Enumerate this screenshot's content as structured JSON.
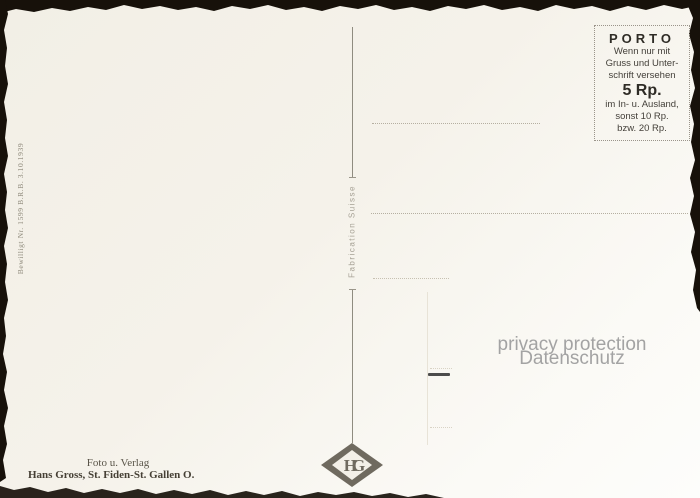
{
  "postcard": {
    "porto_box": {
      "title": "PORTO",
      "lines_top": [
        "Wenn nur mit",
        "Gruss und Unter-",
        "schrift versehen"
      ],
      "rate": "5 Rp.",
      "lines_bottom": [
        "im In- u. Ausland,",
        "sonst 10 Rp.",
        "bzw. 20 Rp."
      ]
    },
    "center_divider_label": "Fabrication Suisse",
    "left_authorization": "Bewilligt Nr. 1599 B.R.B. 3.10.1939",
    "publisher": {
      "line1": "Foto u. Verlag",
      "line2": "Hans Gross, St. Fiden-St. Gallen O."
    },
    "logo_monogram": "HG",
    "watermark": {
      "line1": "privacy protection",
      "line2": "Datenschutz"
    },
    "colors": {
      "paper": "#f4f1e9",
      "scan_edge": "#17110a",
      "ink_dark": "#2f2c26",
      "ink_gray": "#8f8a7c",
      "dotted_line": "#b5afa1",
      "watermark_gray": "#a3a3a3",
      "logo_gray": "#6f6a5f"
    }
  }
}
